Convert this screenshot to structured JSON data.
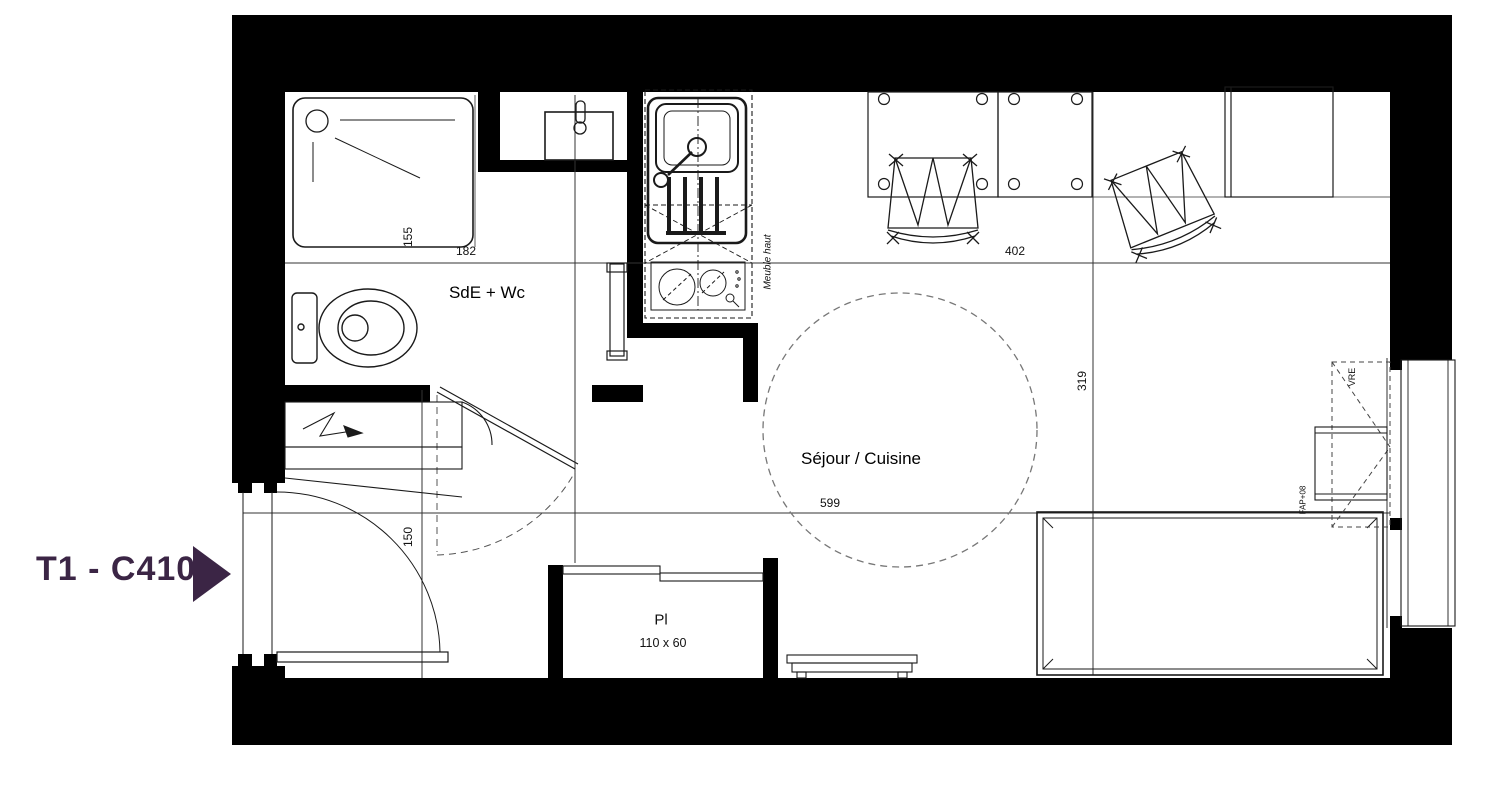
{
  "plan": {
    "title": "T1 - C410",
    "rooms": {
      "bathroom": "SdE + Wc",
      "living": "Séjour / Cuisine",
      "closet": "Pl",
      "closet_size": "110 x 60"
    },
    "dimensions": {
      "shower_width": "155",
      "shower_length": "182",
      "living_width": "402",
      "living_depth": "319",
      "living_length": "599",
      "entry_width": "150"
    },
    "annotations": {
      "upper_cabinet": "Meuble haut",
      "roller_shutter": "VRE",
      "window_sill": "FAP+08"
    },
    "colors": {
      "accent": "#3b2545",
      "line": "#1a1a1a"
    }
  }
}
